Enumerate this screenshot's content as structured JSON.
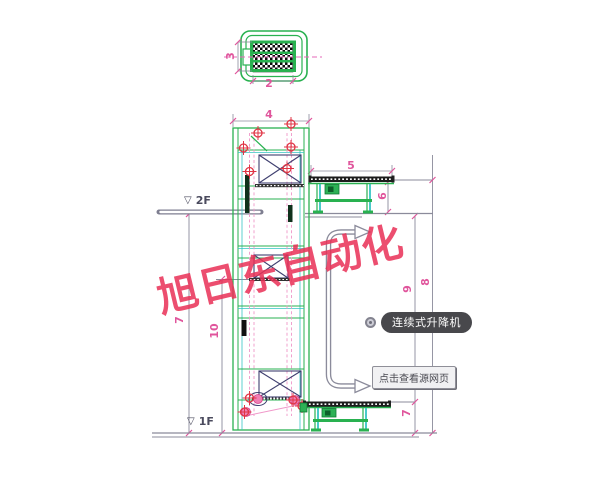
{
  "watermark": {
    "text": "旭日东自动化",
    "color": "#e93056"
  },
  "floor_labels": {
    "datum_symbol": "▽",
    "floor2": "2F",
    "floor1": "1F"
  },
  "links": {
    "product_badge": "连续式升降机",
    "source_tooltip": "点击查看源网页"
  },
  "dimensions": {
    "plan_width": "2",
    "plan_depth": "3",
    "tower_width": "4",
    "upper_conveyor_length": "5",
    "upper_conveyor_height": "6",
    "floor2_height_left": "7",
    "tower_inner_height": "10",
    "floor2_to_lower_conveyor": "9",
    "overall_height": "8",
    "lower_conveyor_height": "7"
  },
  "colors": {
    "frame_green": "#29b150",
    "accent_teal": "#35c4c4",
    "dimension_pink": "#e0559c",
    "chain_pink": "#f097c9",
    "marker_red": "#e03545",
    "carrier_navy": "#3f3f6f",
    "line_gray": "#8b8b9b",
    "watermark_red": "#e93056",
    "badge_background": "#48484c",
    "badge_text": "#ffffff"
  }
}
